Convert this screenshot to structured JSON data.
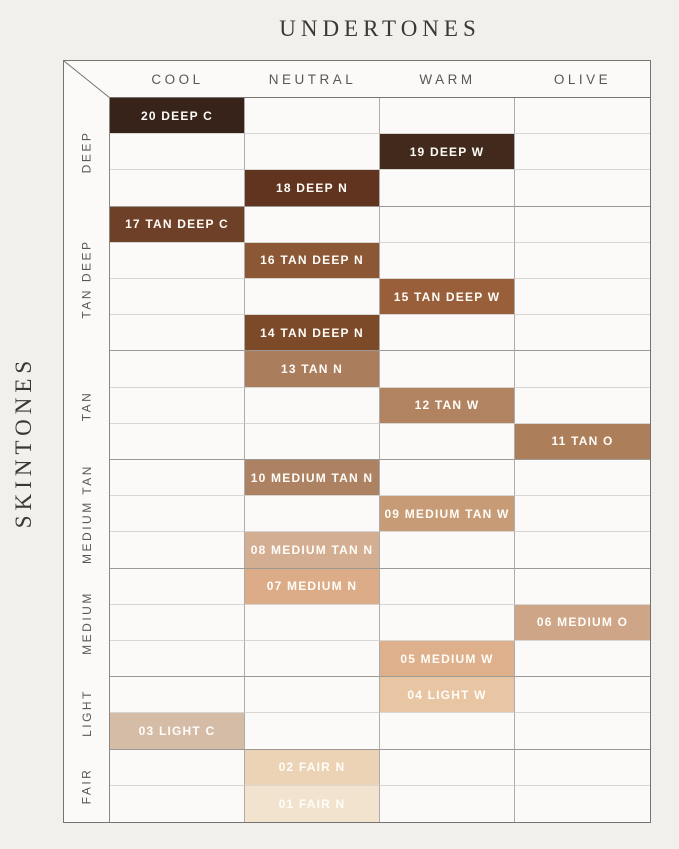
{
  "axes": {
    "x_title": "UNDERTONES",
    "y_title": "SKINTONES"
  },
  "chart_data": {
    "type": "heatmap",
    "title": "UNDERTONES",
    "xlabel": "UNDERTONES",
    "ylabel": "SKINTONES",
    "x_categories": [
      "COOL",
      "NEUTRAL",
      "WARM",
      "OLIVE"
    ],
    "skintone_groups": [
      {
        "label": "DEEP",
        "rows": 3
      },
      {
        "label": "TAN DEEP",
        "rows": 4
      },
      {
        "label": "TAN",
        "rows": 3
      },
      {
        "label": "MEDIUM TAN",
        "rows": 3
      },
      {
        "label": "MEDIUM",
        "rows": 3
      },
      {
        "label": "LIGHT",
        "rows": 2
      },
      {
        "label": "FAIR",
        "rows": 2
      }
    ],
    "y_categories": [
      "20 DEEP C",
      "19 DEEP W",
      "18 DEEP N",
      "17 TAN DEEP C",
      "16 TAN DEEP N",
      "15 TAN DEEP W",
      "14 TAN DEEP N",
      "13 TAN N",
      "12 TAN W",
      "11 TAN O",
      "10 MEDIUM TAN N",
      "09 MEDIUM TAN W",
      "08 MEDIUM TAN N",
      "07 MEDIUM N",
      "06 MEDIUM O",
      "05 MEDIUM W",
      "04 LIGHT W",
      "03 LIGHT C",
      "02 FAIR N",
      "01 FAIR N"
    ],
    "cells": [
      {
        "row": 1,
        "shade": "20 DEEP C",
        "undertone": "COOL",
        "skintone_group": "DEEP",
        "color": "#37231a"
      },
      {
        "row": 2,
        "shade": "19 DEEP W",
        "undertone": "WARM",
        "skintone_group": "DEEP",
        "color": "#412a1c"
      },
      {
        "row": 3,
        "shade": "18 DEEP N",
        "undertone": "NEUTRAL",
        "skintone_group": "DEEP",
        "color": "#61341f"
      },
      {
        "row": 4,
        "shade": "17 TAN DEEP C",
        "undertone": "COOL",
        "skintone_group": "TAN DEEP",
        "color": "#6f4028"
      },
      {
        "row": 5,
        "shade": "16 TAN DEEP N",
        "undertone": "NEUTRAL",
        "skintone_group": "TAN DEEP",
        "color": "#8b5735"
      },
      {
        "row": 6,
        "shade": "15 TAN DEEP W",
        "undertone": "WARM",
        "skintone_group": "TAN DEEP",
        "color": "#985f3a"
      },
      {
        "row": 7,
        "shade": "14 TAN DEEP N",
        "undertone": "NEUTRAL",
        "skintone_group": "TAN DEEP",
        "color": "#7c4a29"
      },
      {
        "row": 8,
        "shade": "13 TAN N",
        "undertone": "NEUTRAL",
        "skintone_group": "TAN",
        "color": "#aa7d5c"
      },
      {
        "row": 9,
        "shade": "12 TAN W",
        "undertone": "WARM",
        "skintone_group": "TAN",
        "color": "#b28361"
      },
      {
        "row": 10,
        "shade": "11 TAN O",
        "undertone": "OLIVE",
        "skintone_group": "TAN",
        "color": "#ad7e5a"
      },
      {
        "row": 11,
        "shade": "10 MEDIUM TAN N",
        "undertone": "NEUTRAL",
        "skintone_group": "MEDIUM TAN",
        "color": "#ad8262"
      },
      {
        "row": 12,
        "shade": "09 MEDIUM TAN W",
        "undertone": "WARM",
        "skintone_group": "MEDIUM TAN",
        "color": "#c69b75"
      },
      {
        "row": 13,
        "shade": "08 MEDIUM TAN N",
        "undertone": "NEUTRAL",
        "skintone_group": "MEDIUM TAN",
        "color": "#d3ae92"
      },
      {
        "row": 14,
        "shade": "07 MEDIUM N",
        "undertone": "NEUTRAL",
        "skintone_group": "MEDIUM",
        "color": "#dcab88"
      },
      {
        "row": 15,
        "shade": "06 MEDIUM O",
        "undertone": "OLIVE",
        "skintone_group": "MEDIUM",
        "color": "#cea687"
      },
      {
        "row": 16,
        "shade": "05 MEDIUM W",
        "undertone": "WARM",
        "skintone_group": "MEDIUM",
        "color": "#dfb08c"
      },
      {
        "row": 17,
        "shade": "04 LIGHT W",
        "undertone": "WARM",
        "skintone_group": "LIGHT",
        "color": "#e9c6a3"
      },
      {
        "row": 18,
        "shade": "03 LIGHT C",
        "undertone": "COOL",
        "skintone_group": "LIGHT",
        "color": "#d5bca6"
      },
      {
        "row": 19,
        "shade": "02 FAIR N",
        "undertone": "NEUTRAL",
        "skintone_group": "FAIR",
        "color": "#edd3b5"
      },
      {
        "row": 20,
        "shade": "01 FAIR N",
        "undertone": "NEUTRAL",
        "skintone_group": "FAIR",
        "color": "#f1e3cd"
      }
    ],
    "layout": {
      "grid": "on",
      "legend": "none",
      "colors": {
        "page_background": "#f1f0ed",
        "cell_background": "#fbfaf8",
        "outer_border": "#76746f",
        "row_line": "#d8d6d2",
        "group_line": "#9c9994",
        "column_line": "#aeaca8",
        "cell_text": "#fffdf9",
        "label_text": "#5a5855",
        "title_text": "#3b3731"
      }
    }
  }
}
